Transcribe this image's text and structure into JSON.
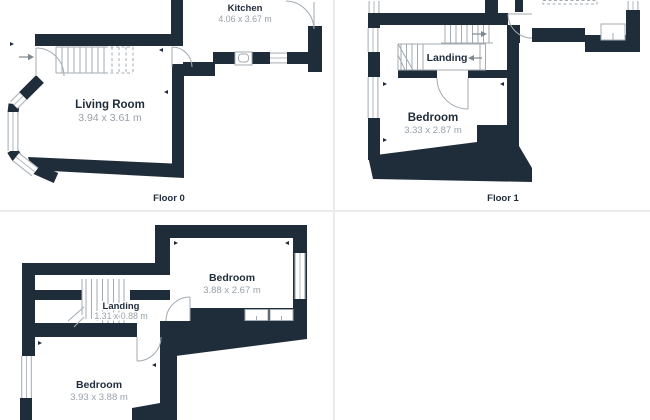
{
  "page": {
    "background_color": "#ffffff",
    "wall_color": "#1f2c3a",
    "room_name_color": "#1f2c3a",
    "dimension_text_color": "#98a1a9",
    "grid_line_color": "#e9ebec",
    "symbol_line_color": "#a3abb2"
  },
  "floor_plans": [
    {
      "floor_label": "Floor 0",
      "rooms": [
        {
          "name": "Kitchen",
          "dims": "4.06 x 3.67 m"
        },
        {
          "name": "Living Room",
          "dims": "3.94 x 3.61 m"
        }
      ]
    },
    {
      "floor_label": "Floor 1",
      "rooms": [
        {
          "name": "Landing"
        },
        {
          "name": "Bedroom",
          "dims": "3.33 x 2.87 m"
        }
      ]
    },
    {
      "rooms": [
        {
          "name": "Bedroom",
          "dims": "3.88 x 2.67 m"
        },
        {
          "name": "Landing",
          "dims": "1.31 x 0.88 m"
        },
        {
          "name": "Bedroom",
          "dims": "3.93 x 3.88 m"
        }
      ]
    }
  ]
}
